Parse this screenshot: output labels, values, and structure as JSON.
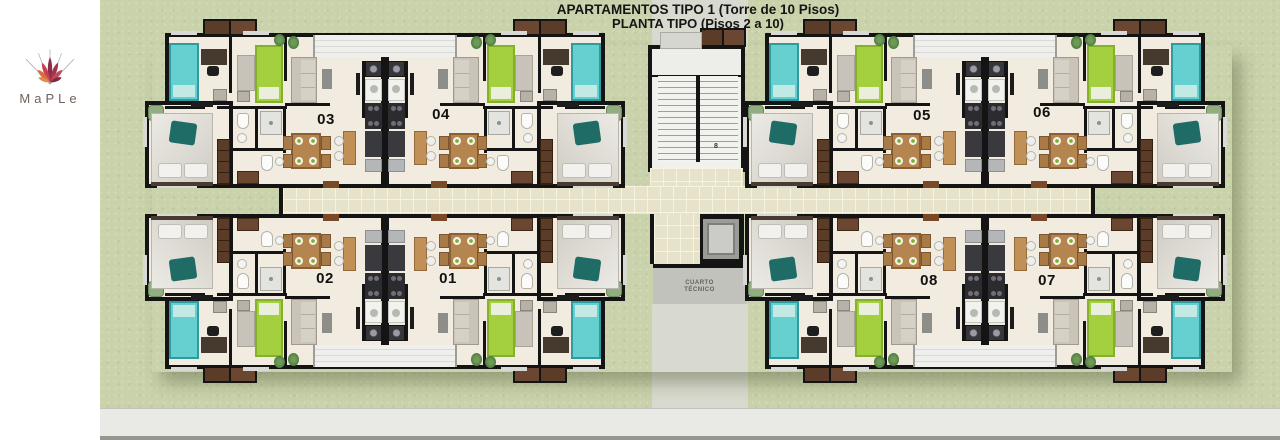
{
  "header": {
    "title_line1": "APARTAMENTOS TIPO 1 (Torre de 10 Pisos)",
    "title_line2": "PLANTA TIPO (Pisos 2 a 10)"
  },
  "logo": {
    "brand": "MaPLe"
  },
  "plan": {
    "apartment_numbers": [
      "01",
      "02",
      "03",
      "04",
      "05",
      "06",
      "07",
      "08"
    ],
    "core": {
      "technical_room_line1": "CUARTO",
      "technical_room_line2": "TÉCNICO",
      "stair_label": "8"
    },
    "colors": {
      "grass": "#c9d2ab",
      "floor": "#f1ecdf",
      "wall": "#141414",
      "corridor_tile": "#e7e3cb",
      "teal_bed": "#66cfd0",
      "green_bed": "#a4cf3f",
      "master_throw_teal": "#1f6b66",
      "wood": "#b5854f",
      "logo_orange": "#e08b4c",
      "logo_maroon": "#8e2d4b",
      "sidewalk": "#e9eae6"
    }
  }
}
